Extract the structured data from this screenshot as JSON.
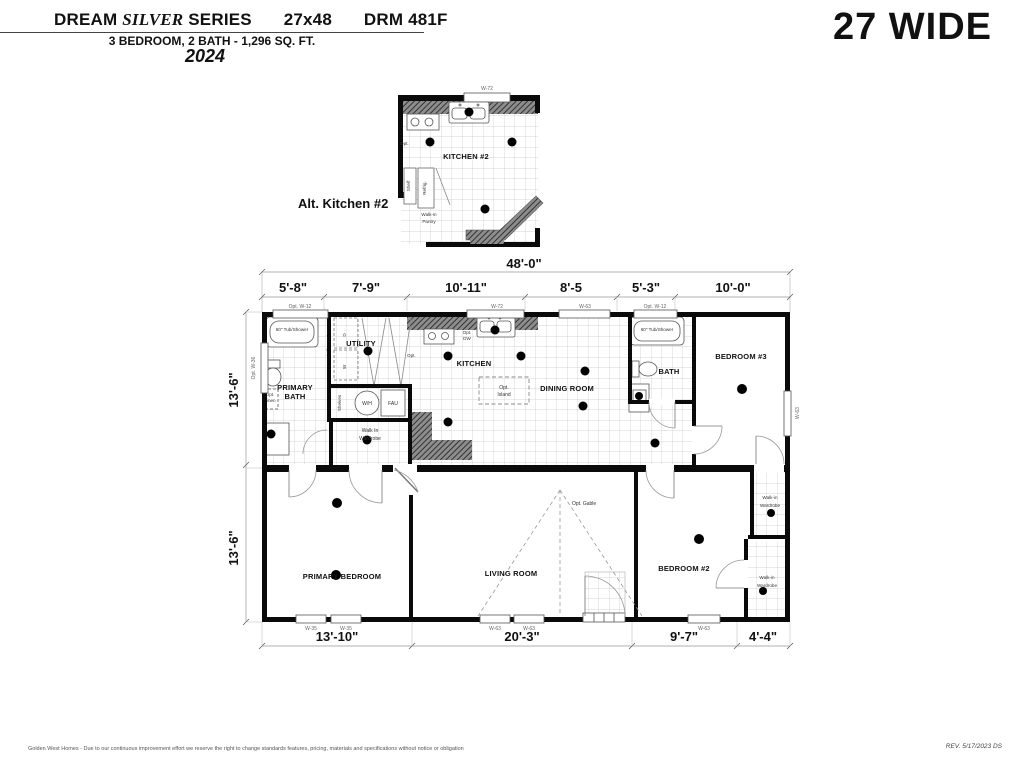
{
  "header": {
    "series_prefix": "DREAM",
    "series_italic": "SILVER",
    "series_suffix": "SERIES",
    "size": "27x48",
    "model": "DRM 481F",
    "subtitle": "3 BEDROOM, 2 BATH - 1,296 SQ. FT.",
    "year": "2024",
    "wide_label": "27 WIDE"
  },
  "alt_kitchen": {
    "caption": "Alt. Kitchen #2",
    "room": "KITCHEN #2",
    "window": "W-72",
    "shelf": "Shelf",
    "refrig": "Refrig.",
    "pantry_1": "Walk-in",
    "pantry_2": "Pantry",
    "opt": "Opt."
  },
  "dims": {
    "overall": "48'-0\"",
    "top": [
      "5'-8\"",
      "7'-9\"",
      "10'-11\"",
      "8'-5",
      "5'-3\"",
      "10'-0\""
    ],
    "left_upper": "13'-6\"",
    "left_lower": "13'-6\"",
    "bottom": [
      "13'-10\"",
      "20'-3\"",
      "9'-7\"",
      "4'-4\""
    ]
  },
  "windows": {
    "top1": "Opt. W-12",
    "top2": "W-72",
    "top3": "W-63",
    "top4": "Opt. W-12",
    "left": "Opt. W-36",
    "right": "W-63",
    "bottom1": "W-35",
    "bottom2": "W-35",
    "bottom3": "W-63",
    "bottom4": "W-63",
    "bottom5": "W-63"
  },
  "rooms": {
    "primary_bath_1": "PRIMARY",
    "primary_bath_2": "BATH",
    "utility": "UTILITY",
    "kitchen": "KITCHEN",
    "dining": "DINING ROOM",
    "bath": "BATH",
    "bedroom3": "BEDROOM #3",
    "primary_bedroom": "PRIMARY BEDROOM",
    "living": "LIVING ROOM",
    "bedroom2": "BEDROOM #2",
    "walkin_1": "Walk In",
    "walkin_2": "Wardrobe",
    "wr_1": "Walk-in",
    "wr_2": "Wardrobe"
  },
  "fixtures": {
    "tub": "60\" Tub/Shower",
    "opt_linen_1": "Opt.",
    "opt_linen_2": "Linen",
    "shelf_rod": "Opt. Shelf & Rod",
    "dryer": "D",
    "washer": "W",
    "shelves": "Shelves",
    "wh": "W/H",
    "fau": "FAU",
    "opt_dw_1": "Opt.",
    "opt_dw_2": "DW",
    "island_1": "Opt.",
    "island_2": "Island",
    "gable": "Opt. Gable",
    "opt": "Opt."
  },
  "footer": {
    "disclaimer": "Golden West Homes - Due to our continuous improvement effort we reserve the right to change standards features, pricing, materials and specifications without notice or obligation",
    "revision": "REV. 5/17/2023  DS"
  }
}
